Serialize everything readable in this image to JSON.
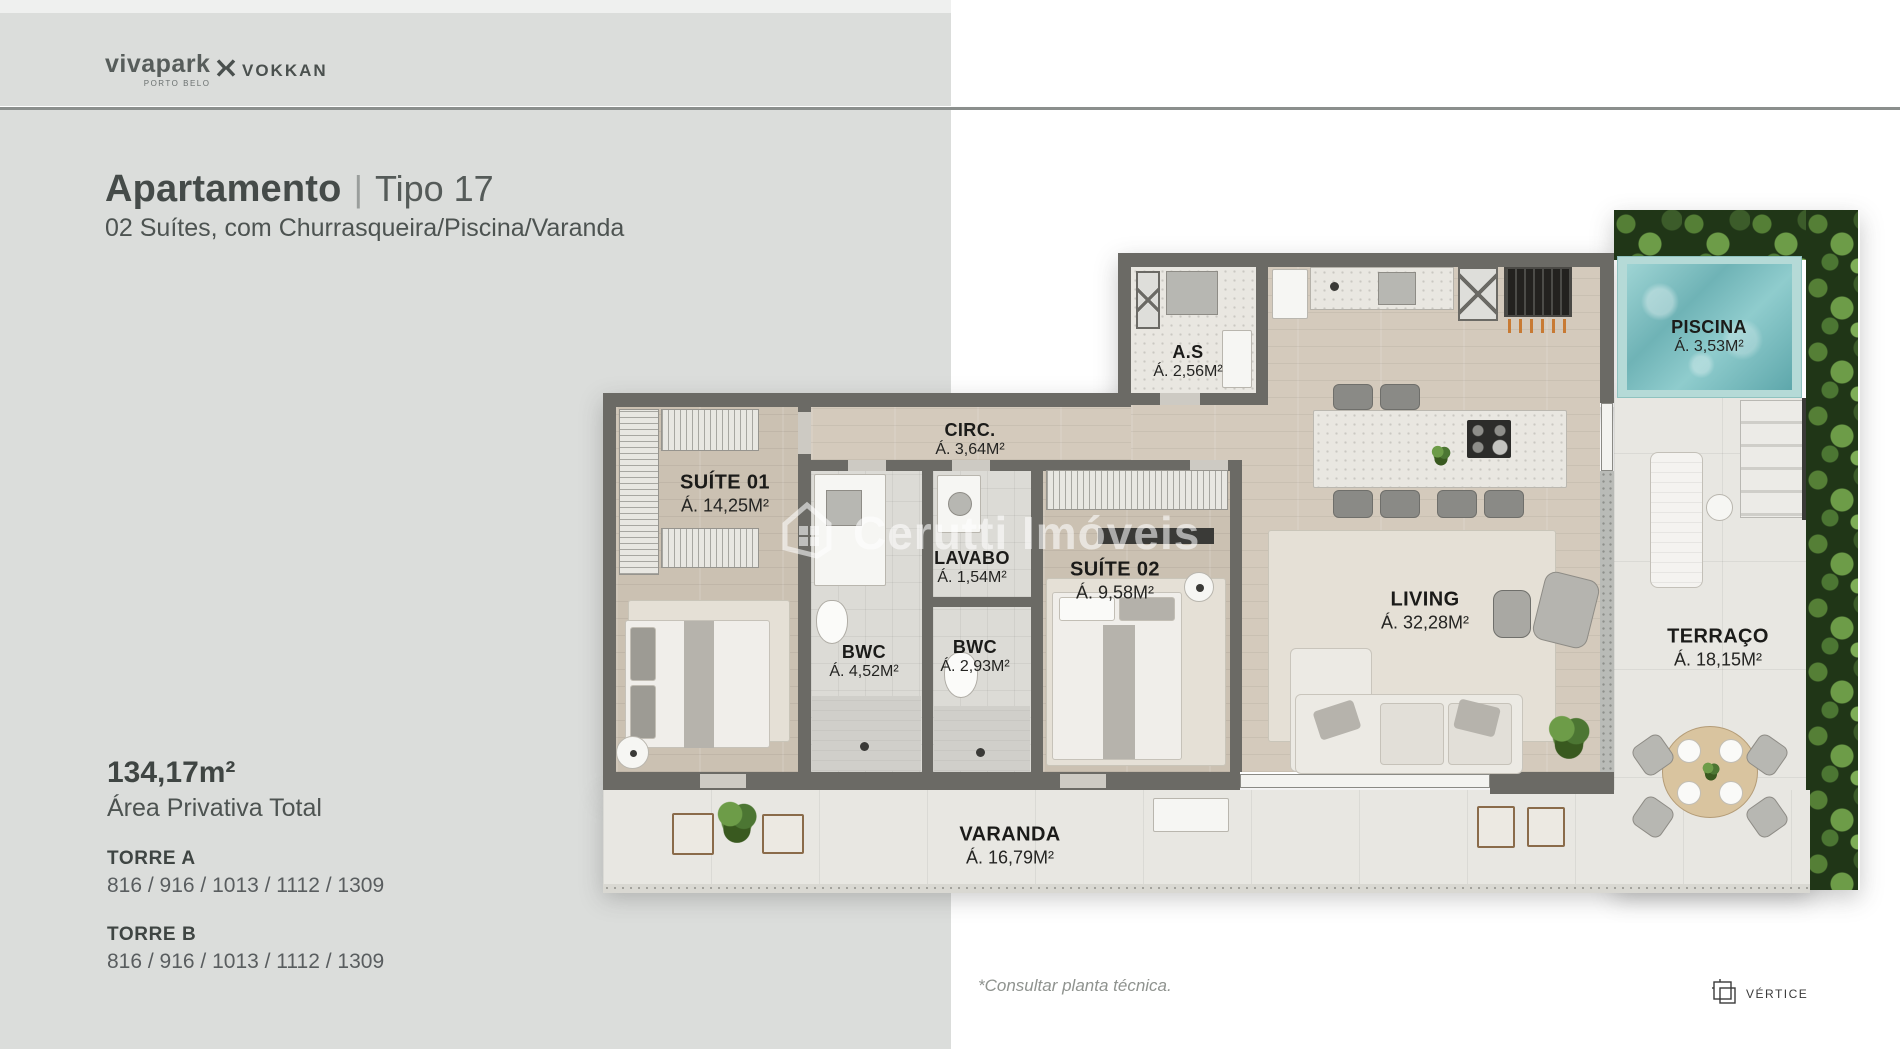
{
  "header": {
    "brand_primary": "vivapark",
    "brand_primary_sub": "PORTO BELO",
    "brand_secondary": "VOKKAN"
  },
  "title": {
    "main": "Apartamento",
    "separator": "|",
    "variant": "Tipo 17",
    "subtitle": "02 Suítes, com Churrasqueira/Piscina/Varanda"
  },
  "summary": {
    "area_total": "134,17m²",
    "area_label": "Área Privativa Total",
    "towers": [
      {
        "name": "TORRE A",
        "units": "816 / 916 / 1013 / 1112 / 1309"
      },
      {
        "name": "TORRE B",
        "units": "816 / 916 / 1013 / 1112 / 1309"
      }
    ]
  },
  "floorplan": {
    "watermark": "Cerutti Imóveis",
    "rooms": [
      {
        "name": "SUÍTE 01",
        "area": "Á. 14,25M²"
      },
      {
        "name": "CIRC.",
        "area": "Á. 3,64M²"
      },
      {
        "name": "A.S",
        "area": "Á. 2,56M²"
      },
      {
        "name": "LAVABO",
        "area": "Á. 1,54M²"
      },
      {
        "name": "BWC",
        "area": "Á. 4,52M²"
      },
      {
        "name": "BWC",
        "area": "Á. 2,93M²"
      },
      {
        "name": "SUÍTE 02",
        "area": "Á. 9,58M²"
      },
      {
        "name": "LIVING",
        "area": "Á. 32,28M²"
      },
      {
        "name": "PISCINA",
        "area": "Á. 3,53M²"
      },
      {
        "name": "TERRAÇO",
        "area": "Á. 18,15M²"
      },
      {
        "name": "VARANDA",
        "area": "Á. 16,79M²"
      }
    ]
  },
  "footer": {
    "note": "*Consultar planta técnica.",
    "agency": "VÉRTICE"
  },
  "colors": {
    "page_gray": "#dbdddb",
    "wall": "#6b6a65",
    "wood_floor": "#cbc1b2",
    "pool_water": "#6fb3b6",
    "greenery": "#4c7633",
    "text_dark": "#3f4543"
  }
}
